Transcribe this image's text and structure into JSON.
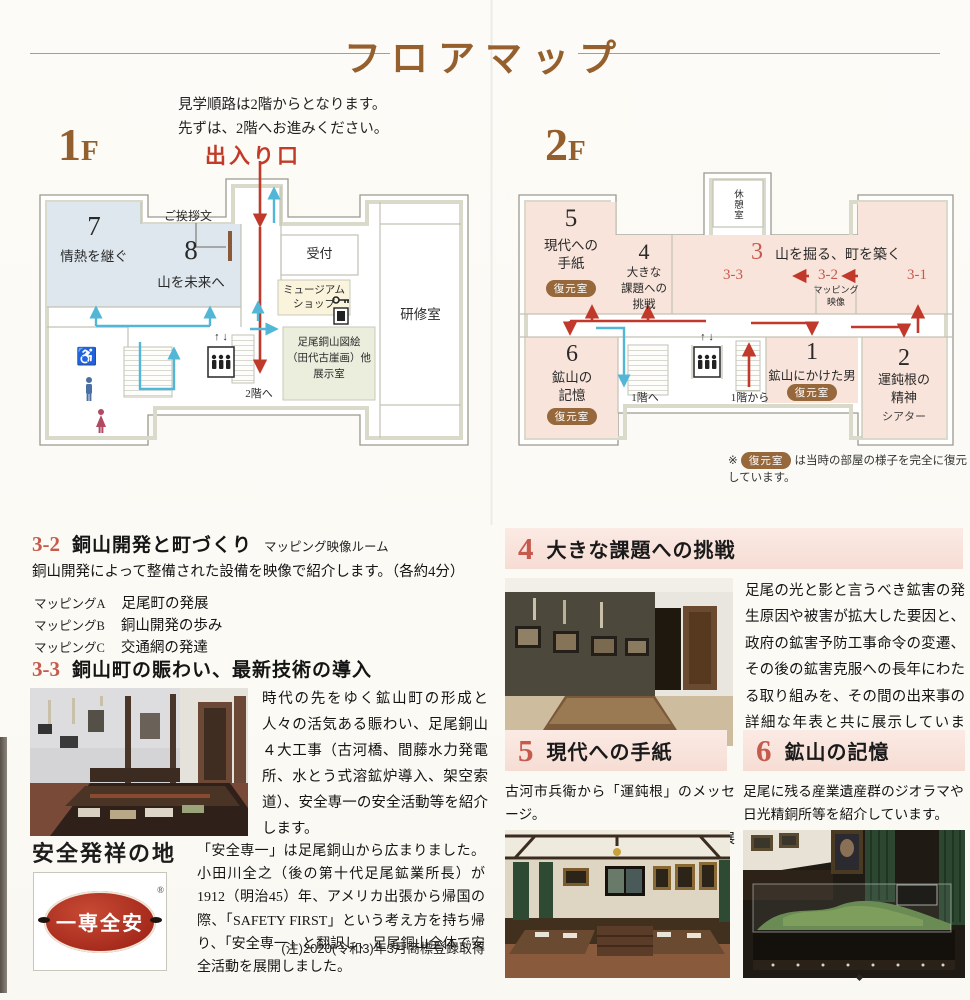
{
  "header": {
    "title": "フロアマップ",
    "intro1": "見学順路は2階からとなります。",
    "intro2": "先ずは、2階へお進みください。",
    "entrance": "出入り口",
    "f1_num": "1",
    "f1_suffix": "F",
    "f2_num": "2",
    "f2_suffix": "F"
  },
  "common": {
    "badge": "復元室",
    "note_mark": "※",
    "note_text": "は当時の部屋の様子を完全に復元しています。",
    "icons": {
      "wheelchair": "♿",
      "elevator_up": "↑",
      "elevator_down": "↓"
    }
  },
  "floor1": {
    "room7_num": "7",
    "room7_name": "情熱を継ぐ",
    "room8_num": "8",
    "room8_name": "山を未来へ",
    "greeting": "ご挨拶文",
    "reception": "受付",
    "shop_l1": "ミュージアム",
    "shop_l2": "ショップ",
    "training": "研修室",
    "exhibit_l1": "足尾銅山図絵",
    "exhibit_l2": "（田代古崖画）他",
    "exhibit_l3": "展示室",
    "to2f": "2階へ"
  },
  "floor2": {
    "rest": "休憩室",
    "r5_num": "5",
    "r5_l1": "現代への",
    "r5_l2": "手紙",
    "r4_num": "4",
    "r4_l1": "大きな",
    "r4_l2": "課題への",
    "r4_l3": "挑戦",
    "r3_num": "3",
    "r3_name": "山を掘る、町を築く",
    "s33": "3-3",
    "s32": "3-2",
    "s31": "3-1",
    "map_l1": "マッピング",
    "map_l2": "映像",
    "r6_num": "6",
    "r6_l1": "鉱山の",
    "r6_l2": "記憶",
    "r1_num": "1",
    "r1_name": "鉱山にかけた男",
    "r2_num": "2",
    "r2_l1": "運鈍根の",
    "r2_l2": "精神",
    "r2_sub": "シアター",
    "to1f": "1階へ",
    "from1f": "1階から"
  },
  "sections": {
    "s32": {
      "num": "3-2",
      "title": "銅山開発と町づくり",
      "subtitle": "マッピング映像ルーム",
      "body": "銅山開発によって整備された設備を映像で紹介します。（各約4分）",
      "list": [
        {
          "label": "マッピングA",
          "text": "足尾町の発展"
        },
        {
          "label": "マッピングB",
          "text": "銅山開発の歩み"
        },
        {
          "label": "マッピングC",
          "text": "交通網の発達"
        }
      ]
    },
    "s33": {
      "num": "3-3",
      "title": "銅山町の賑わい、最新技術の導入",
      "body": "時代の先をゆく鉱山町の形成と人々の活気ある賑わい、足尾銅山４大工事（古河橋、間藤水力発電所、水とう式溶鉱炉導入、架空索道）、安全専一の安全活動等を紹介します。"
    },
    "safety": {
      "title": "安全発祥の地",
      "logo_text": "一専全安",
      "logo_reg": "®",
      "body": "「安全専一」は足尾銅山から広まりました。小田川全之（後の第十代足尾鉱業所長）が1912（明治45）年、アメリカ出張から帰国の際、「SAFETY FIRST」という考え方を持ち帰り、「安全専一」と翻訳し、足尾銅山全体で安全活動を展開しました。",
      "note": "(注)2020(令和3)年3月商標登録取得"
    },
    "s4": {
      "num": "4",
      "title": "大きな課題への挑戦",
      "body": "足尾の光と影と言うべき鉱害の発生原因や被害が拡大した要因と、政府の鉱害予防工事命令の変遷、その後の鉱害克服への長年にわたる取り組みを、その間の出来事の詳細な年表と共に展示しています。"
    },
    "s5": {
      "num": "5",
      "title": "現代への手紙",
      "body_l1": "古河市兵衛から「運鈍根」のメッセージ。",
      "body_l2": "壁面には古河家当主の肖像画を展示。"
    },
    "s6": {
      "num": "6",
      "title": "鉱山の記憶",
      "body_l1": "足尾に残る産業遺産群のジオラマや",
      "body_l2": "日光精銅所等を紹介しています。"
    }
  },
  "colors": {
    "title_brown": "#96602e",
    "accent_red": "#c0392b",
    "accent_cyan": "#52b7d6",
    "room_blue": "#dde7ed",
    "room_pink": "#f8e4da",
    "room_green": "#ebeedd",
    "badge_brown": "#96683c",
    "banner_pink": "#f6ddd4",
    "number_red": "#c65a4d",
    "number_blue": "#7b9cb3",
    "logo_red": "#a62a1c"
  }
}
